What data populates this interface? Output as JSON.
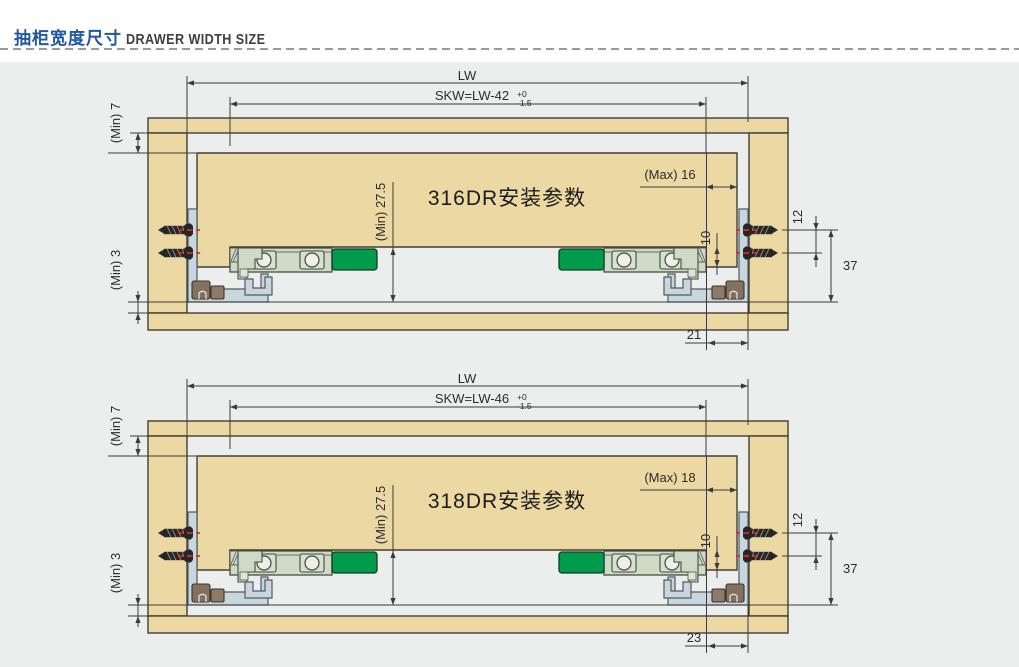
{
  "header": {
    "title_zh": "抽柜宽度尺寸",
    "title_en": "DRAWER WIDTH SIZE"
  },
  "shared": {
    "lw": "LW",
    "min7": "(Min) 7",
    "min3": "(Min) 3",
    "min_depth": "(Min) 27.5",
    "dim10": "10",
    "dim12": "12",
    "dim37": "37"
  },
  "diagrams": [
    {
      "title": "316DR安装参数",
      "skw": "SKW=LW-42",
      "tol_plus": "+0",
      "tol_minus": "-1.5",
      "max": "(Max) 16",
      "bottom_offset": "21"
    },
    {
      "title": "318DR安装参数",
      "skw": "SKW=LW-46",
      "tol_plus": "+0",
      "tol_minus": "-1.5",
      "max": "(Max) 18",
      "bottom_offset": "23"
    }
  ],
  "colors": {
    "accent_blue": "#1E57A5",
    "wood_tan": "#ECD8A3",
    "rail_green": "#009B4B",
    "rail_body": "#CFDAC6",
    "bracket_blue": "#C9D6DE",
    "screw_red": "#D93025",
    "panel_bg": "#ECEEED"
  }
}
